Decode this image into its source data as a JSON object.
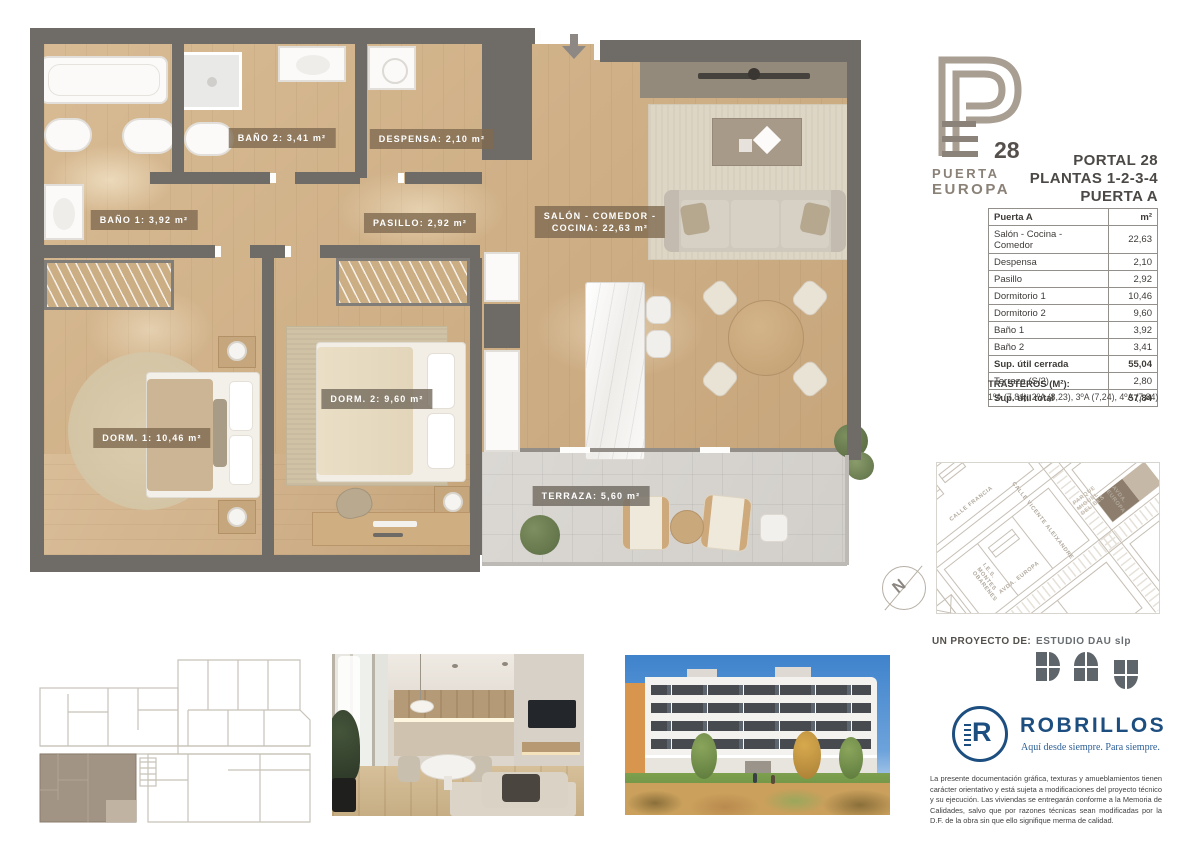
{
  "branding": {
    "monogram_number": "28",
    "name_line1": "PUERTA",
    "name_line2": "EUROPA"
  },
  "header": {
    "line1": "PORTAL 28",
    "line2": "PLANTAS 1-2-3-4",
    "line3": "PUERTA A"
  },
  "area_table": {
    "col_name": "Puerta A",
    "col_unit": "m²",
    "rows": [
      {
        "name": "Salón - Cocina - Comedor",
        "value": "22,63"
      },
      {
        "name": "Despensa",
        "value": "2,10"
      },
      {
        "name": "Pasillo",
        "value": "2,92"
      },
      {
        "name": "Dormitorio 1",
        "value": "10,46"
      },
      {
        "name": "Dormitorio 2",
        "value": "9,60"
      },
      {
        "name": "Baño 1",
        "value": "3,92"
      },
      {
        "name": "Baño 2",
        "value": "3,41"
      },
      {
        "name": "Sup. útil cerrada",
        "value": "55,04"
      },
      {
        "name": "Terraza (S/2)",
        "value": "2,80"
      },
      {
        "name": "Sup. útil total",
        "value": "57,84"
      }
    ]
  },
  "trasteros": {
    "title": "TRASTEROS (M²):",
    "values": "1ºA (7,84), 2ºA (8,23), 3ºA (7,24), 4ºA (7,84)"
  },
  "floorplan_labels": {
    "bano2": "BAÑO 2: 3,41 m²",
    "despensa": "DESPENSA: 2,10 m²",
    "bano1": "BAÑO 1: 3,92 m²",
    "pasillo": "PASILLO: 2,92 m²",
    "salon": "SALÓN - COMEDOR -\nCOCINA: 22,63 m²",
    "dorm1": "DORM. 1: 10,46 m²",
    "dorm2": "DORM. 2: 9,60 m²",
    "terraza": "TERRAZA: 5,60 m²"
  },
  "map": {
    "street1": "CALLE FRANCIA",
    "street2": "CALLE VICENTE ALEIXANDRE",
    "street3": "AVDA. EUROPA",
    "street4": "AVDA. EUROPA",
    "park": "PARQUE\nMIGUEL\nDELIBES",
    "school": "I.E.S.\nMONTES\nOBARENES",
    "compass": "N"
  },
  "project": {
    "label": "UN PROYECTO DE:",
    "studio": "ESTUDIO DAU slp"
  },
  "developer": {
    "name": "ROBRILLOS",
    "initial": "R",
    "tagline": "Aquí desde siempre. Para siempre."
  },
  "disclaimer": "La presente documentación gráfica, texturas y amueblamientos tienen carácter orientativo y está sujeta a modificaciones del proyecto técnico y su ejecución. Las viviendas se entregarán conforme a la Memoria de Calidades, salvo que por razones técnicas sean modificadas por la D.F. de la obra sin que ello signifique merma de calidad.",
  "colors": {
    "brand_taupe": "#a89e92",
    "brand_navy": "#1d4e80",
    "wall_gray": "#6f6b67",
    "wood": "#d2b48d",
    "label_badge": "#806a50"
  }
}
